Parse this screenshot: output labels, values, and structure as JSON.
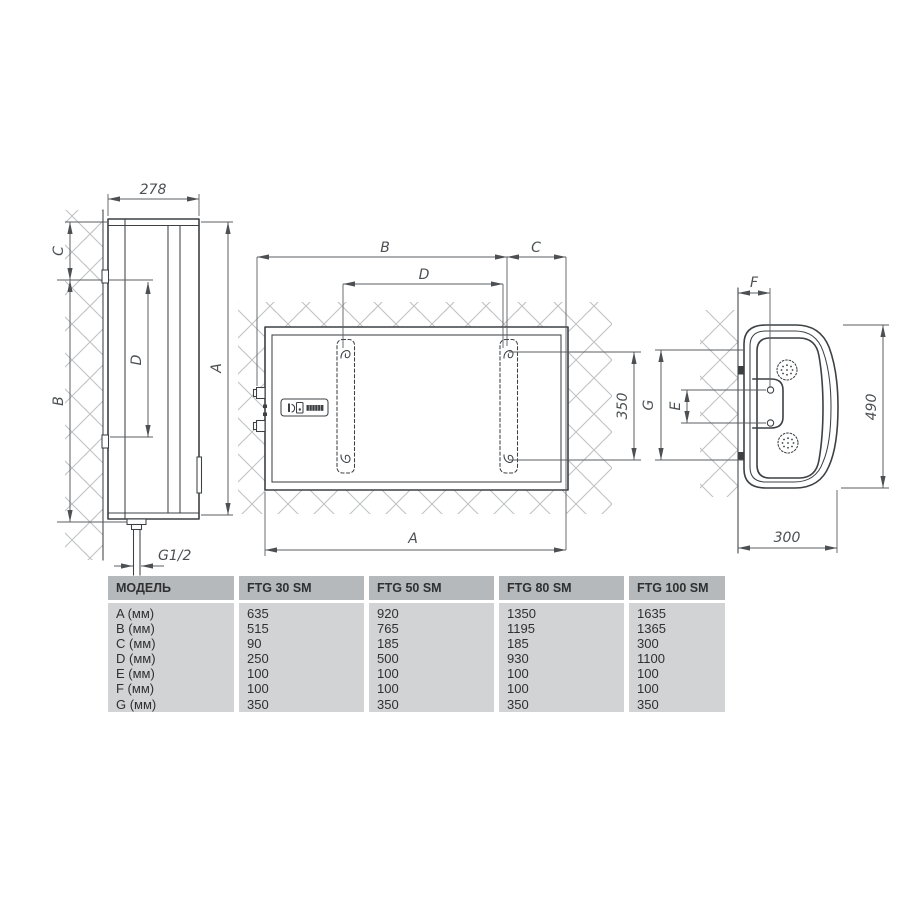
{
  "colors": {
    "background": "#ffffff",
    "object_line": "#3d4144",
    "dimension_line": "#5a5e61",
    "hatch_line": "#bdbfc1",
    "table_header_bg": "#b6b9bb",
    "table_body_bg": "#d1d3d5",
    "text": "#2e3032"
  },
  "drawing": {
    "left_view": {
      "depth": "278",
      "dim_a": "A",
      "dim_b": "B",
      "dim_c": "C",
      "dim_d": "D",
      "pipe_thread": "G1/2"
    },
    "front_view": {
      "dim_a": "A",
      "dim_b": "B",
      "dim_c": "C",
      "dim_d": "D",
      "hook_span": "350"
    },
    "profile_view": {
      "dim_e": "E",
      "dim_f": "F",
      "dim_g": "G",
      "height": "490",
      "depth": "300"
    }
  },
  "table": {
    "columns": [
      {
        "header": "МОДЕЛЬ",
        "lines": [
          "A (мм)",
          "B (мм)",
          "C (мм)",
          "D (мм)",
          "E (мм)",
          "F (мм)",
          "G (мм)"
        ]
      },
      {
        "header": "FTG 30 SM",
        "lines": [
          "635",
          "515",
          "90",
          "250",
          "100",
          "100",
          "350"
        ]
      },
      {
        "header": "FTG 50 SM",
        "lines": [
          "920",
          "765",
          "185",
          "500",
          "100",
          "100",
          "350"
        ]
      },
      {
        "header": "FTG 80 SM",
        "lines": [
          "1350",
          "1195",
          "185",
          "930",
          "100",
          "100",
          "350"
        ]
      },
      {
        "header": "FTG 100 SM",
        "lines": [
          "1635",
          "1365",
          "300",
          "1100",
          "100",
          "100",
          "350"
        ]
      }
    ]
  }
}
